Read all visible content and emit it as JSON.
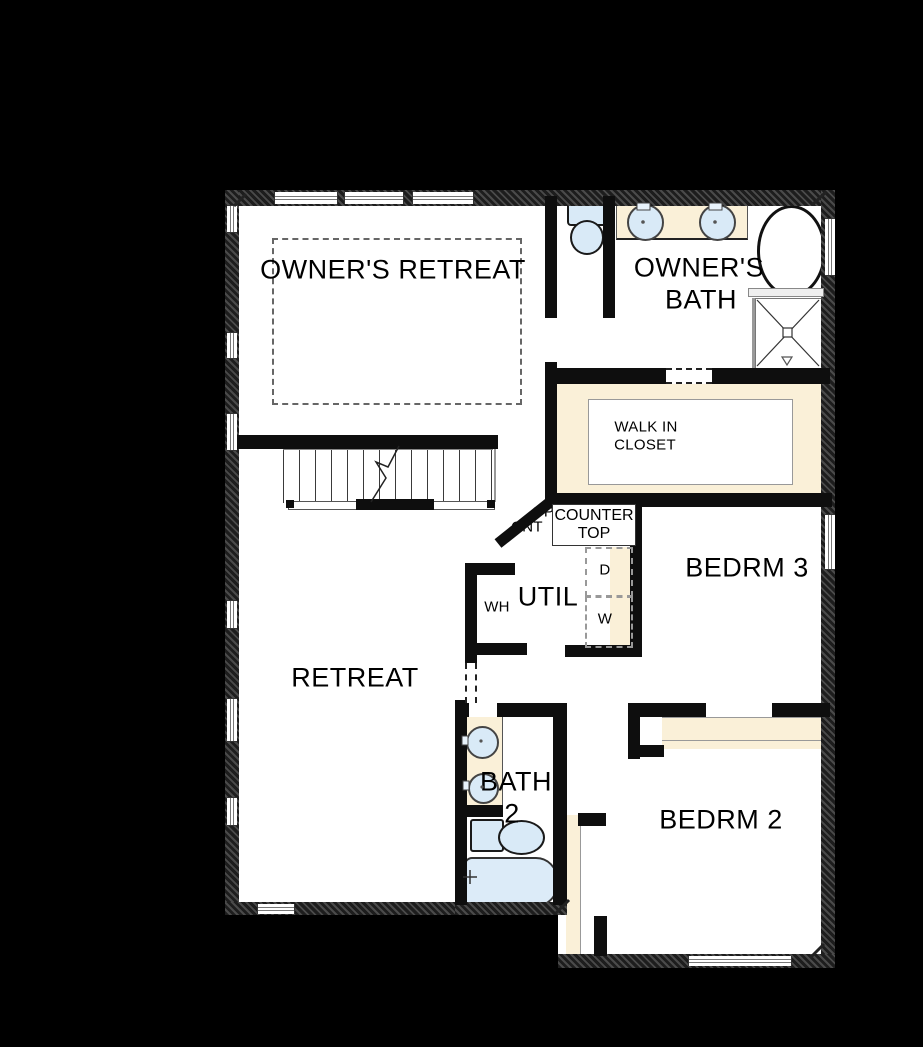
{
  "plan": {
    "type": "floor-plan",
    "labels": {
      "owners_retreat": "OWNER'S RETREAT",
      "owners_bath_line1": "OWNER'S",
      "owners_bath_line2": "BATH",
      "walk_in_closet_line1": "WALK IN",
      "walk_in_closet_line2": "CLOSET",
      "counter_top_line1": "COUNTER",
      "counter_top_line2": "TOP",
      "opt_counter_line1": "OP",
      "opt_counter_line2": "CNT",
      "bedroom3": "BEDRM 3",
      "utility": "UTIL",
      "water_heater": "WH",
      "dryer": "D",
      "washer": "W",
      "retreat": "RETREAT",
      "bath2_line1": "BATH",
      "bath2_line2": "2",
      "bedroom2": "BEDRM 2"
    },
    "colors": {
      "background": "#000000",
      "floor": "#ffffff",
      "wall": "#0e0e0e",
      "shelf_counter": "#faf0d8",
      "fixture_blue": "#d9eaf7",
      "tub_blue": "#dcebf8"
    },
    "fixtures": {
      "owners_bath": [
        "toilet-icon",
        "sink-icon",
        "sink-icon",
        "oval-bathtub-icon",
        "shower-icon"
      ],
      "bath_2": [
        "sink-icon",
        "sink-icon",
        "toilet-icon",
        "bathtub-icon"
      ],
      "utility": [
        "water-heater-icon",
        "dryer-icon",
        "washer-icon"
      ],
      "circulation": [
        "staircase-icon"
      ]
    }
  }
}
